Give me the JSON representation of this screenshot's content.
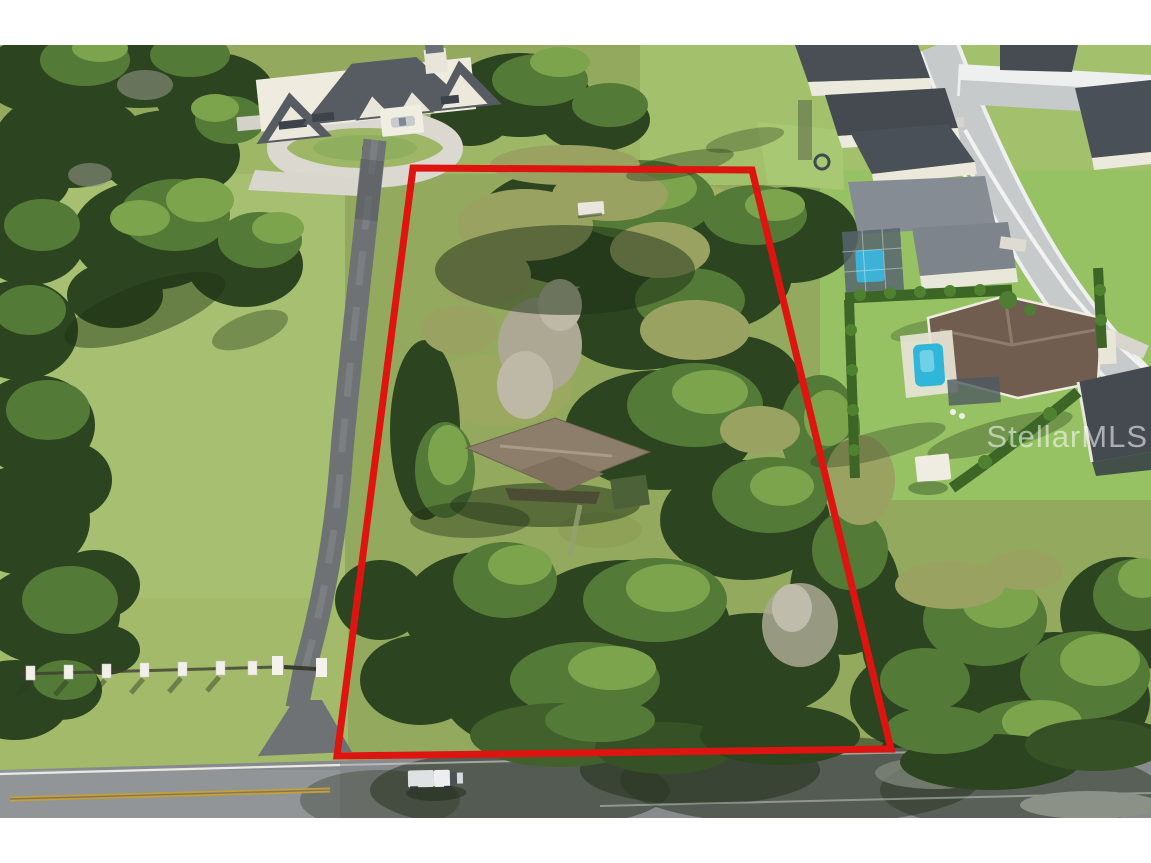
{
  "photo": {
    "description": "Aerial drone photograph of a large tree-covered residential lot outlined in red, with a mansion and long private driveway to the left, a suburban neighborhood with pools to the upper right, and a two-lane road along the bottom.",
    "frame_color": "#ffffff"
  },
  "watermark": {
    "text": "StellarMLS",
    "color": "#ffffff",
    "opacity": "0.55"
  },
  "boundary": {
    "points": "413,168 752,170 891,749 337,756",
    "color": "#de1410",
    "stroke_width": "7"
  },
  "palette": {
    "grass_base": "#93aa5e",
    "grass_light": "#a7bf70",
    "lawn_bright": "#96c263",
    "canopy_dark": "#2c441f",
    "canopy_mid": "#547a37",
    "canopy_light": "#7ca44c",
    "canopy_olive": "#9aa262",
    "canopy_dead": "#aca893",
    "asphalt_driveway": "#6f7274",
    "road_gray": "#878b8d",
    "concrete": "#d9d6cd",
    "roof_dark_gray": "#4a4f56",
    "roof_brown": "#705d50",
    "subject_roof": "#8d7e6b",
    "pool_blue": "#2fb6d8",
    "center_line_yellow": "#c2a03c"
  }
}
